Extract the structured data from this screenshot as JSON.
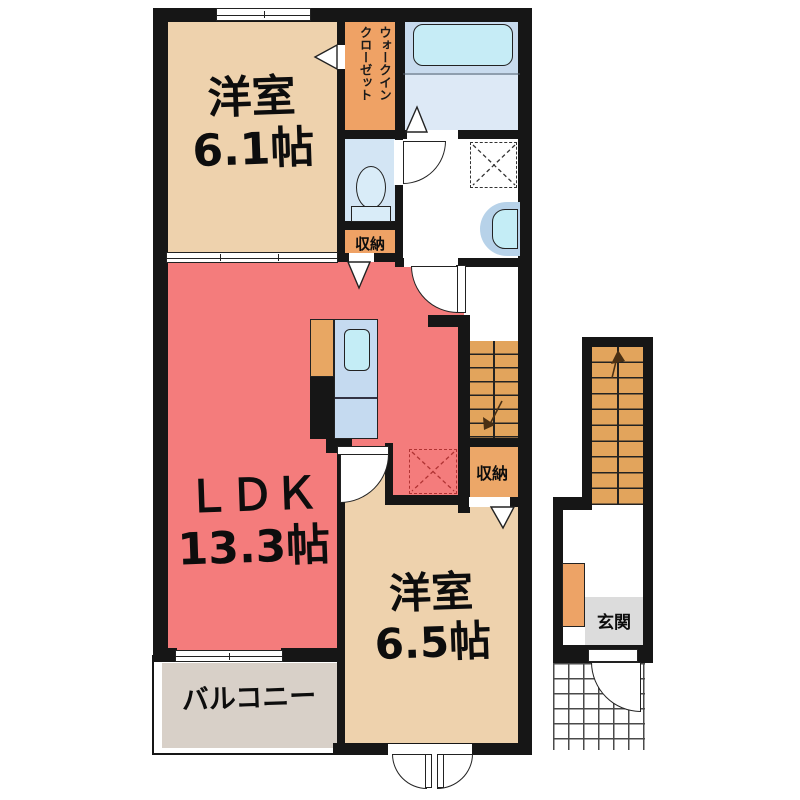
{
  "title": "apartment-floor-plan",
  "rooms": {
    "bedroom_top": {
      "label": "洋室\n6.1帖"
    },
    "walk_in_closet": {
      "label": "ウォークイン\nクローゼット"
    },
    "storage_by_toilet": {
      "label": "収納"
    },
    "ldk": {
      "label": "ＬＤＫ\n13.3帖"
    },
    "storage_by_stairs": {
      "label": "収納"
    },
    "bedroom_bottom": {
      "label": "洋室\n6.5帖"
    },
    "balcony": {
      "label": "バルコニー"
    },
    "entrance": {
      "label": "玄関"
    }
  },
  "colors": {
    "wall": "#161616",
    "bedroom_floor": "#eed2ad",
    "ldk_floor": "#f47c7c",
    "closet_orange": "#efa265",
    "stairs_orange": "#e2a45c",
    "toilet_floor": "#d3e5f4",
    "bath_floor_upper": "#c8dbee",
    "bath_floor_lower": "#dde9f6",
    "bathtub": "#c6ecf6",
    "counter_blue": "#c5daf0",
    "sink_blue": "#c4edf6",
    "basin_outer": "#b7d2e9",
    "balcony_floor": "#d8d0c8",
    "genkan_floor": "#dcdcdc",
    "fridge_dashed": "#b03333"
  }
}
